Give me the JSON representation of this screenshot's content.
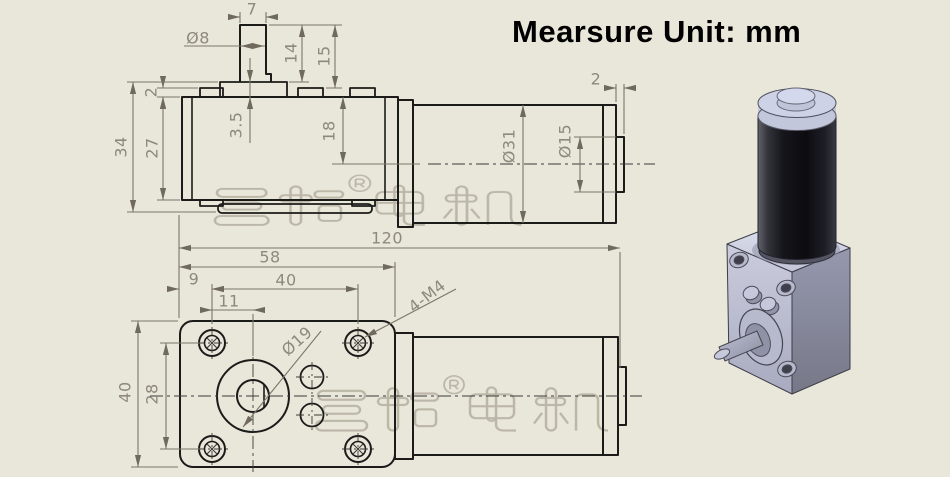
{
  "title": "Mearsure Unit: mm",
  "watermark": {
    "text": "三拓® 电机",
    "style": "hollow-outline",
    "color": "#b3ae9d"
  },
  "drawing": {
    "unit": "mm",
    "views": [
      {
        "name": "side-elevation-view"
      },
      {
        "name": "mounting-face-view"
      },
      {
        "name": "isometric-3d-render"
      }
    ]
  },
  "dimensions": [
    {
      "view": "side",
      "label": "7",
      "x": 252,
      "y": 9,
      "rot": 0
    },
    {
      "view": "side",
      "label": "Ø8",
      "x": 198,
      "y": 38,
      "rot": 0
    },
    {
      "view": "side",
      "label": "14",
      "x": 291,
      "y": 53,
      "rot": -90
    },
    {
      "view": "side",
      "label": "15",
      "x": 324,
      "y": 56,
      "rot": -90
    },
    {
      "view": "side",
      "label": "2",
      "x": 151,
      "y": 92,
      "rot": -90
    },
    {
      "view": "side",
      "label": "3.5",
      "x": 236,
      "y": 125,
      "rot": -90
    },
    {
      "view": "side",
      "label": "18",
      "x": 329,
      "y": 131,
      "rot": -90
    },
    {
      "view": "side",
      "label": "27",
      "x": 152,
      "y": 148,
      "rot": -90
    },
    {
      "view": "side",
      "label": "34",
      "x": 121,
      "y": 147,
      "rot": -90
    },
    {
      "view": "side",
      "label": "Ø31",
      "x": 509,
      "y": 146,
      "rot": -90
    },
    {
      "view": "side",
      "label": "Ø15",
      "x": 565,
      "y": 141,
      "rot": -90
    },
    {
      "view": "side",
      "label": "2",
      "x": 596,
      "y": 79,
      "rot": 0
    },
    {
      "view": "shared",
      "label": "120",
      "x": 387,
      "y": 238,
      "rot": 0
    },
    {
      "view": "bottom",
      "label": "58",
      "x": 270,
      "y": 257,
      "rot": 0
    },
    {
      "view": "bottom",
      "label": "9",
      "x": 194,
      "y": 279,
      "rot": 0
    },
    {
      "view": "bottom",
      "label": "40",
      "x": 286,
      "y": 280,
      "rot": 0
    },
    {
      "view": "bottom",
      "label": "11",
      "x": 229,
      "y": 301,
      "rot": 0
    },
    {
      "view": "bottom",
      "label": "4-M4",
      "x": 427,
      "y": 296,
      "rot": -38
    },
    {
      "view": "bottom",
      "label": "Ø19",
      "x": 297,
      "y": 341,
      "rot": -42
    },
    {
      "view": "bottom",
      "label": "40",
      "x": 125,
      "y": 392,
      "rot": -90
    },
    {
      "view": "bottom",
      "label": "28",
      "x": 152,
      "y": 394,
      "rot": -90
    }
  ],
  "colors": {
    "background": "#e9e6da",
    "object_line": "#1b1b19",
    "dimension_line": "#7b7668",
    "dimension_text": "#8e897b",
    "title_text": "#000000",
    "watermark": "#b3ae9d",
    "motor_body": "#17171d",
    "motor_cap": "#ced2e6",
    "gearbox_front": "#c0c2d5",
    "gearbox_right": "#8b8da3",
    "gearbox_top": "#d5d8e8"
  }
}
